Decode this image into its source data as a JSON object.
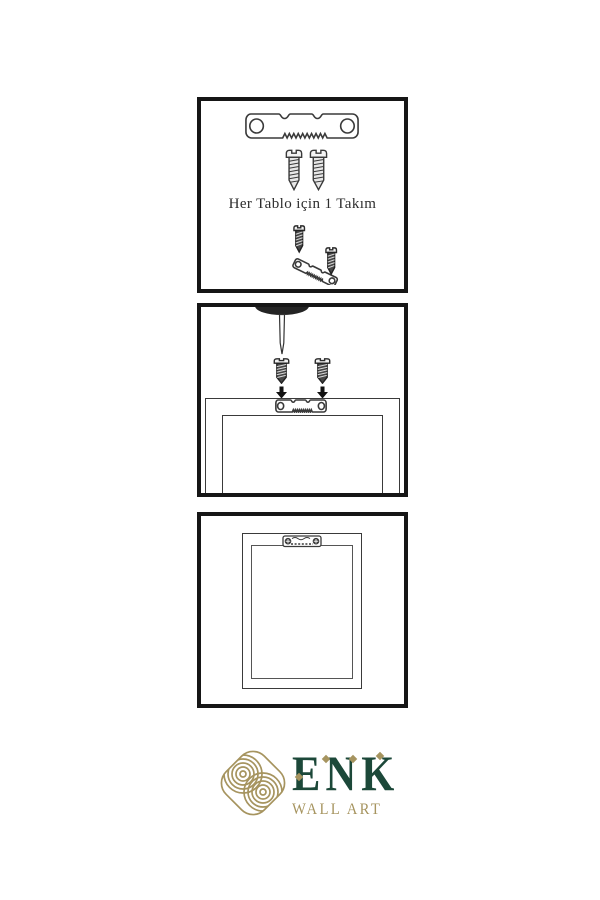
{
  "colors": {
    "background": "#ffffff",
    "line_art": "#3a3a3a",
    "panel_border": "#161616",
    "brand_green": "#1c4839",
    "brand_gold": "#a6945f"
  },
  "panel_kit": {
    "caption": "Her Tablo için 1 Takım"
  },
  "brand": {
    "name": "ENK",
    "tagline": "WALL ART"
  },
  "icons": {
    "sawtooth-hanger-icon": "outlined hanger plate with two holes and sawtooth edge",
    "screw-icon": "slotted screw with threaded shank",
    "screwdriver-icon": "screwdriver tip pointing down",
    "arrow-down-icon": "solid black down arrow",
    "knot-logo-icon": "gold concentric-line knot emblem in rounded diamond",
    "diamond-accent-icon": "small gold rotated square"
  }
}
